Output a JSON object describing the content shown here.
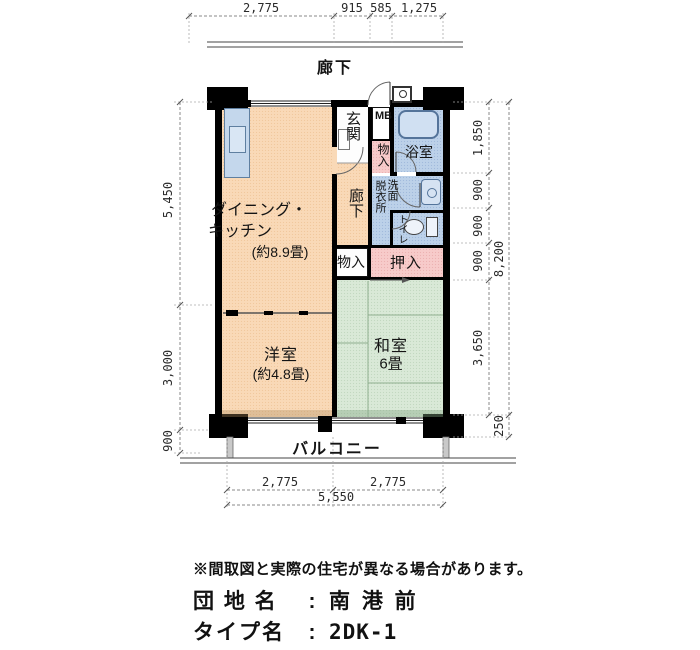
{
  "floorplan": {
    "corridor_top_label": "廊下",
    "balcony_label": "バルコニー",
    "rooms": {
      "dining_kitchen": {
        "line1": "ダイニング・",
        "line2": "キッチン",
        "size": "(約8.9畳)"
      },
      "entrance": "玄関",
      "meter_box": "MB",
      "storage_upper": "物入",
      "bathroom": "浴室",
      "hallway": "廊下",
      "dressing_room": "脱衣所",
      "washstand": "洗面",
      "toilet": "トイレ",
      "storage_lower": "物入",
      "futon_closet": "押入",
      "japanese_room": {
        "name": "和室",
        "size": "6畳"
      },
      "western_room": {
        "name": "洋室",
        "size": "(約4.8畳)"
      }
    },
    "dimensions": {
      "top": [
        "2,775",
        "915",
        "585",
        "1,275"
      ],
      "left": [
        "5,450",
        "3,000",
        "900"
      ],
      "right_inner": [
        "1,850",
        "900",
        "900",
        "900",
        "3,650"
      ],
      "right_outer": [
        "8,200",
        "250"
      ],
      "bottom": [
        "2,775",
        "2,775",
        "5,550"
      ]
    },
    "colors": {
      "room_peach": "#f9d9b7",
      "room_blue": "#bcd1e9",
      "room_green": "#d9e9d7",
      "closet_pink": "#f7cbca",
      "wall_black": "#000000"
    }
  },
  "footer": {
    "note": "※間取図と実際の住宅が異なる場合があります。",
    "estate": {
      "label": "団 地 名",
      "colon": ":",
      "value": "南 港 前"
    },
    "type": {
      "label": "タイプ名",
      "colon": ":",
      "value": "2DK-1"
    }
  }
}
